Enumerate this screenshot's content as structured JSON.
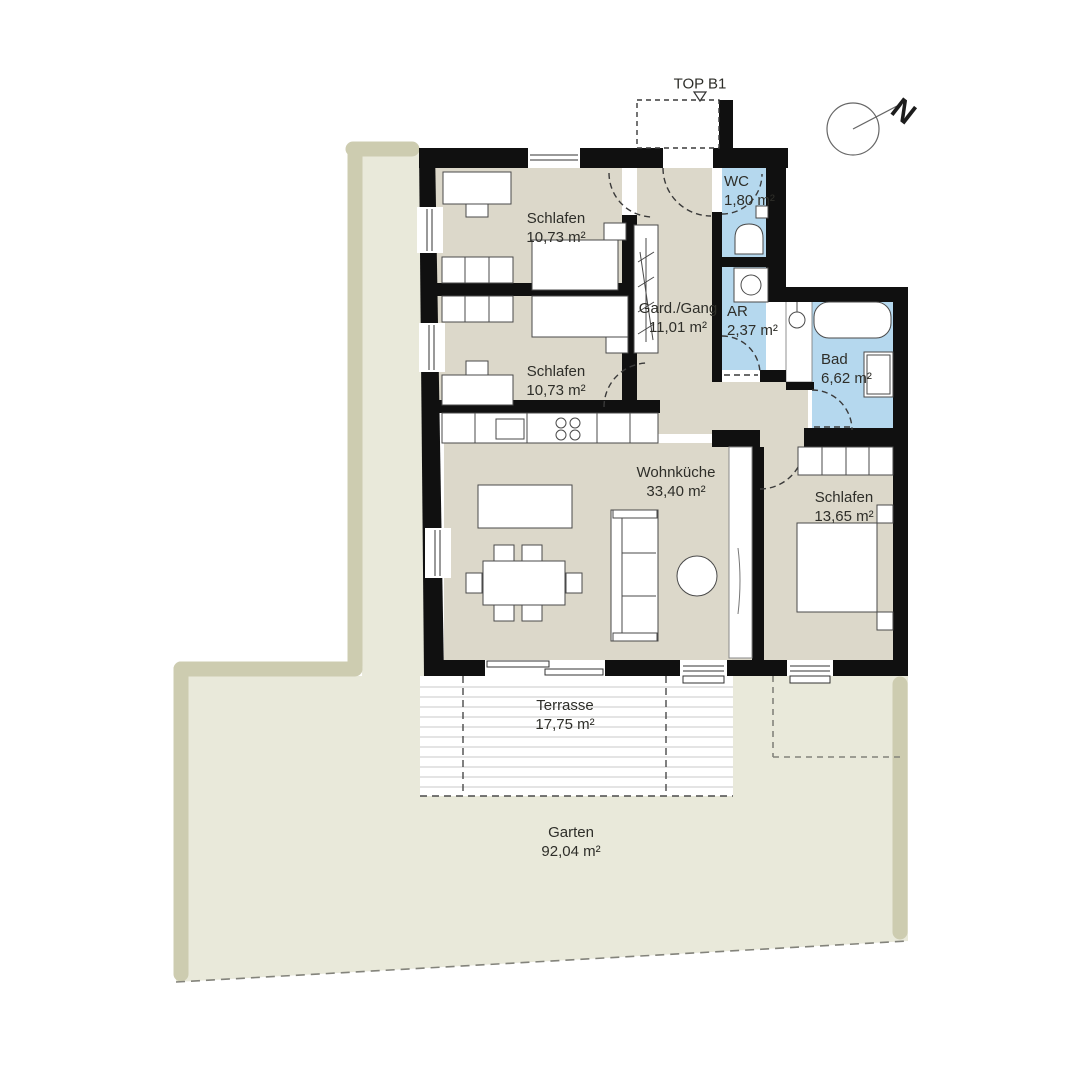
{
  "title": "TOP B1",
  "compass": {
    "label": "N"
  },
  "rooms": {
    "schlafen1": {
      "name": "Schlafen",
      "area": "10,73 m²"
    },
    "schlafen2": {
      "name": "Schlafen",
      "area": "10,73 m²"
    },
    "gang": {
      "name": "Gard./Gang",
      "area": "11,01 m²"
    },
    "wc": {
      "name": "WC",
      "area": "1,80 m²"
    },
    "ar": {
      "name": "AR",
      "area": "2,37 m²"
    },
    "bad": {
      "name": "Bad",
      "area": "6,62 m²"
    },
    "wohnkueche": {
      "name": "Wohnküche",
      "area": "33,40 m²"
    },
    "schlafen3": {
      "name": "Schlafen",
      "area": "13,65 m²"
    },
    "terrasse": {
      "name": "Terrasse",
      "area": "17,75 m²"
    },
    "garten": {
      "name": "Garten",
      "area": "92,04 m²"
    }
  },
  "colors": {
    "wall": "#101010",
    "room_floor": "#dcd8ca",
    "wet_room": "#b5d8ee",
    "garden_light": "#e9e9da",
    "garden_border": "#cdccb0",
    "decking_line": "#c8c8c8"
  }
}
